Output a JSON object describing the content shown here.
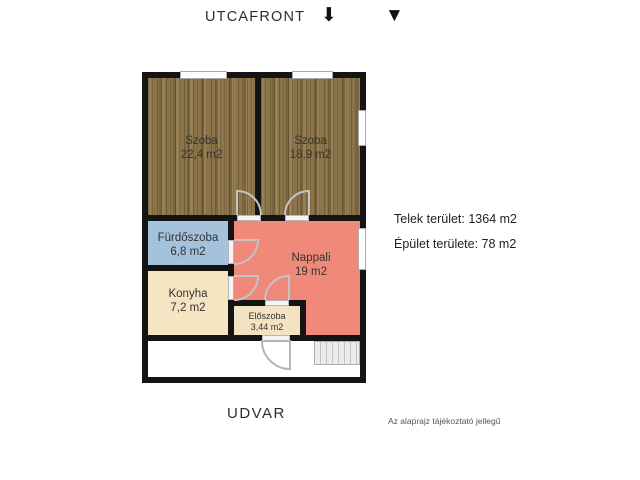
{
  "header": {
    "front_label": "UTCAFRONT",
    "down_arrow_icon": "⬇",
    "down_triangle_icon": "▼"
  },
  "plan": {
    "rooms": [
      {
        "name": "Szoba",
        "area": "22,4 m2"
      },
      {
        "name": "Szoba",
        "area": "18,9 m2"
      },
      {
        "name": "Fürdőszoba",
        "area": "6,8 m2"
      },
      {
        "name": "Konyha",
        "area": "7,2 m2"
      },
      {
        "name": "Nappali",
        "area": "19 m2"
      },
      {
        "name": "Előszoba",
        "area": "3,44 m2"
      }
    ]
  },
  "info": {
    "plot_area": "Telek terület: 1364 m2",
    "building_area": "Épület területe: 78 m2"
  },
  "footer": {
    "yard_label": "UDVAR",
    "disclaimer": "Az alaprajz tájékoztató jellegű"
  },
  "colors": {
    "wall": "#141414",
    "wood_base": "#8b744a",
    "bathroom": "#a4c2dc",
    "kitchen": "#f6e5c3",
    "living": "#f0897a",
    "hall": "#f3e3c0",
    "stairs": "#ececec"
  }
}
